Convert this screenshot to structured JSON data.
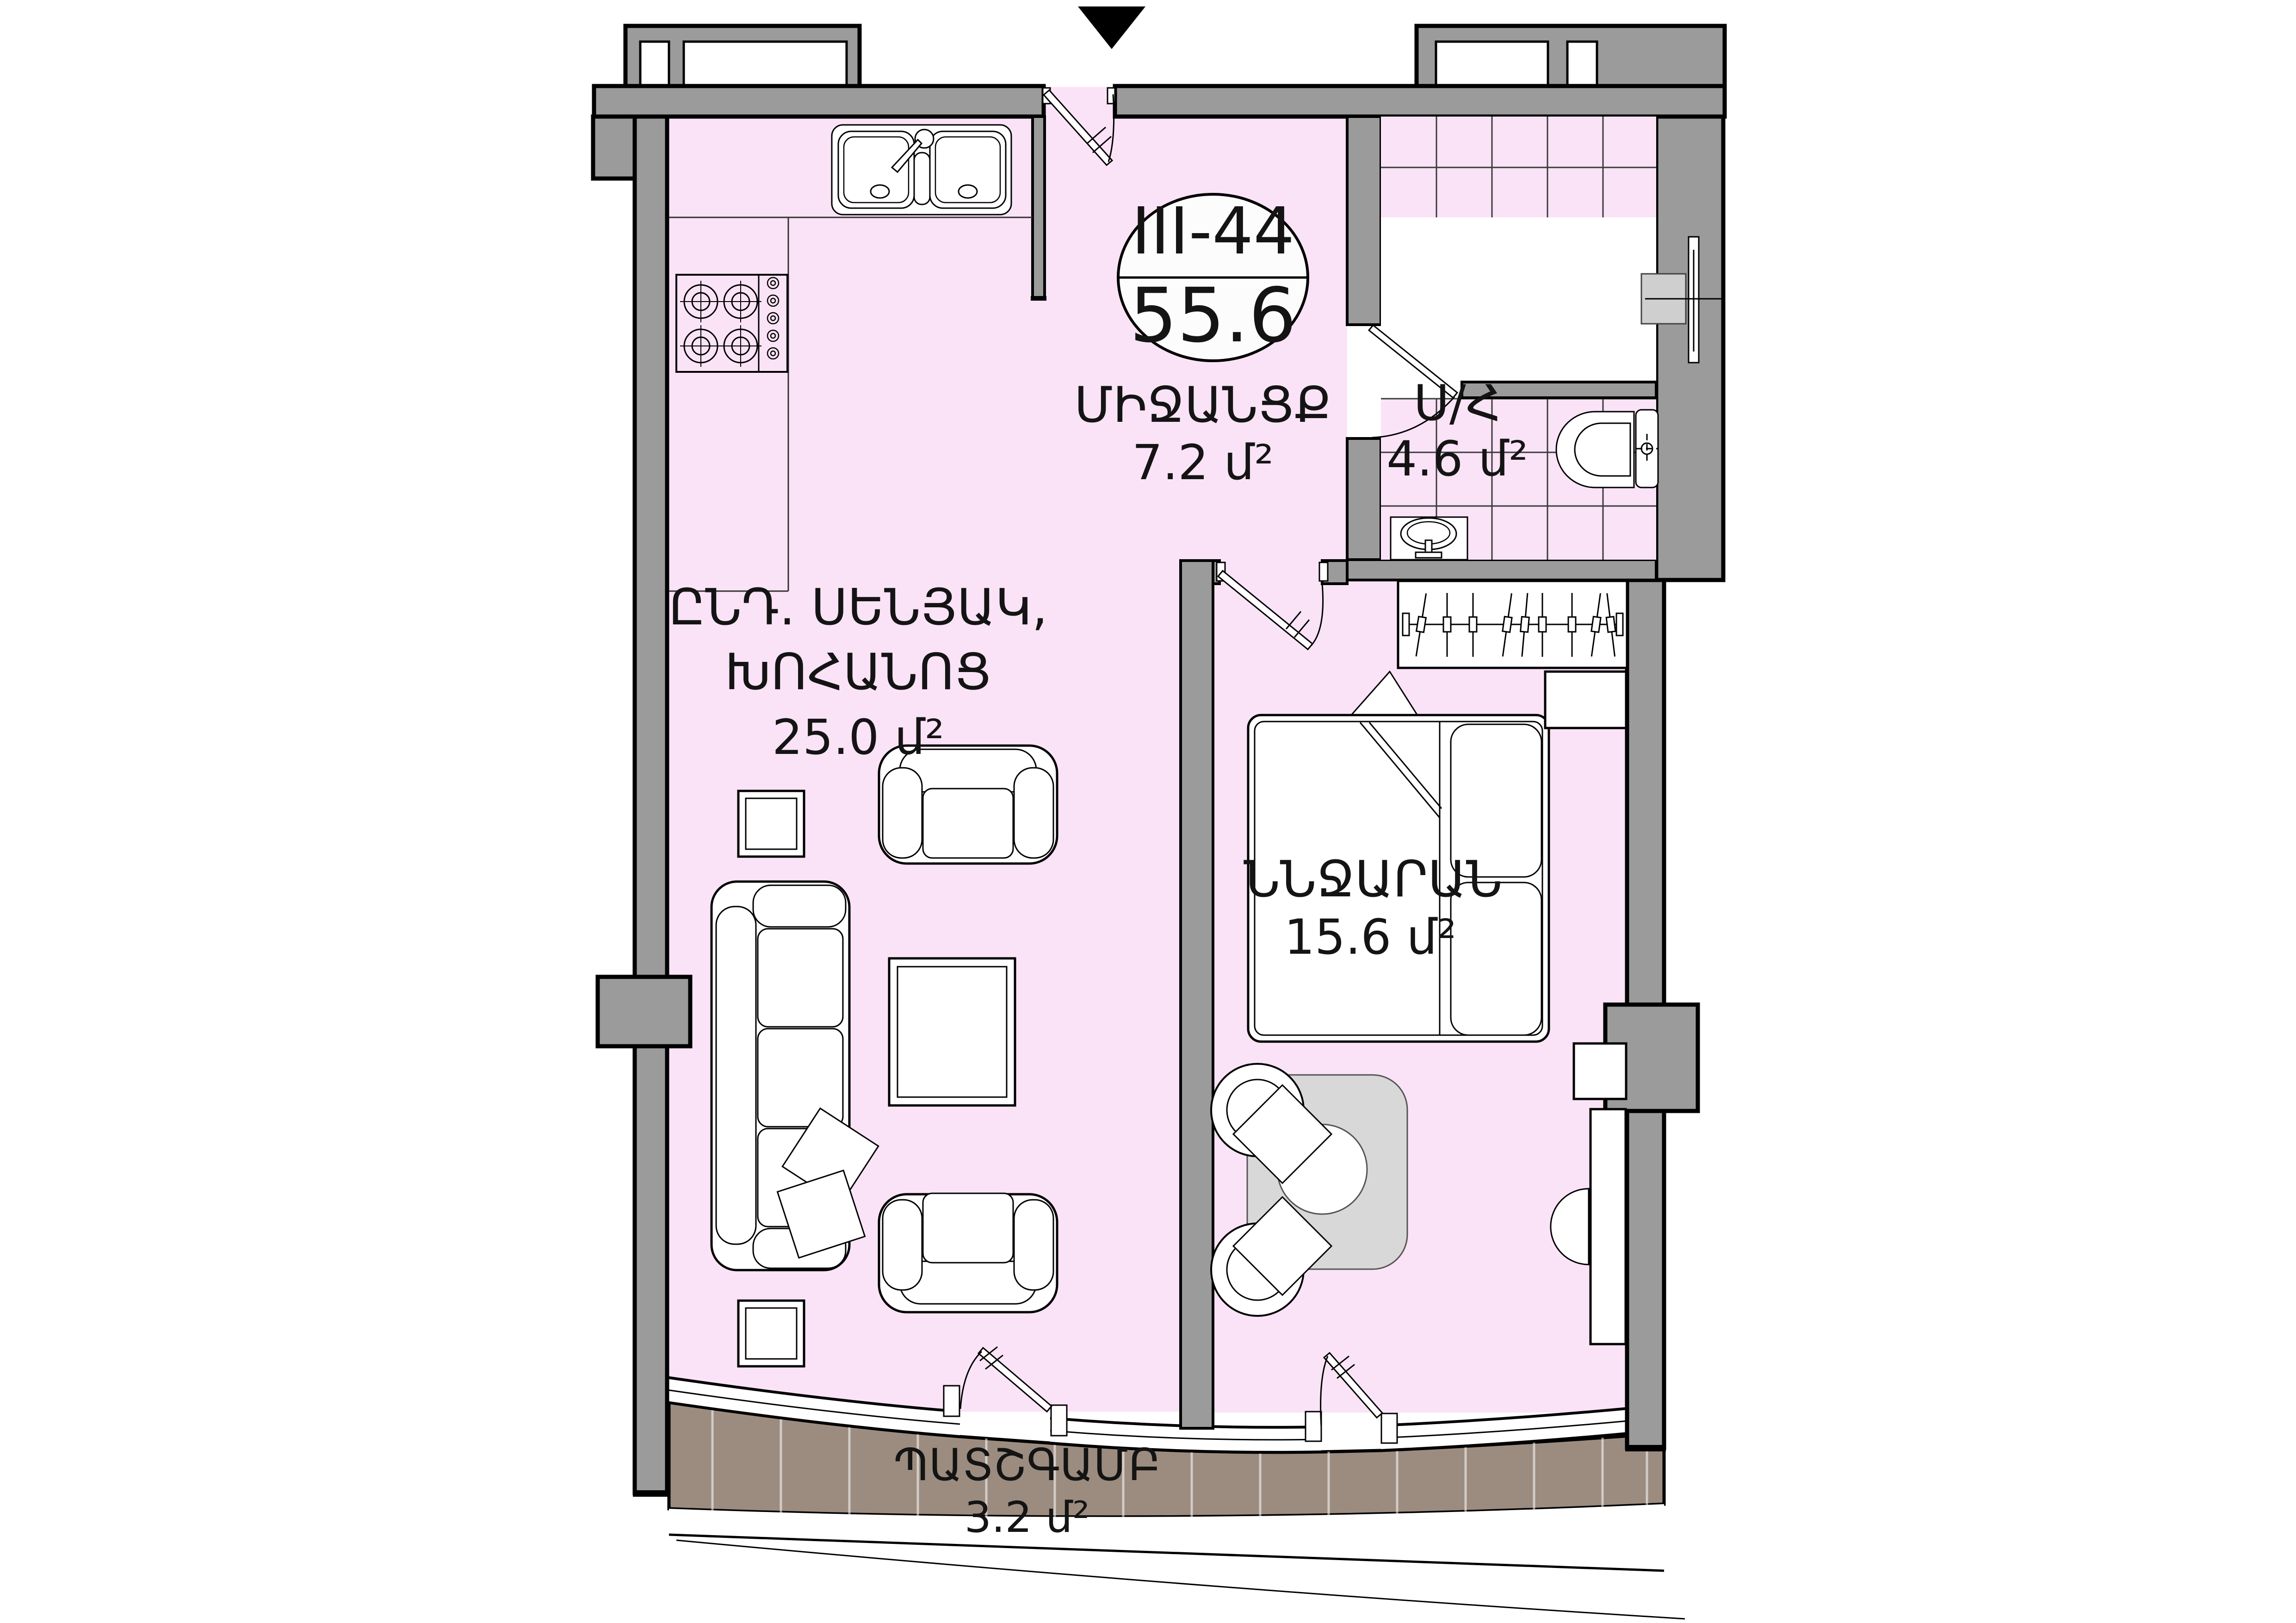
{
  "plan": {
    "unit": {
      "id": "III-44",
      "total_area": "55.6"
    },
    "rooms": {
      "hallway": {
        "name": "ՄԻՋԱՆՑՔ",
        "area": "7.2 մ²"
      },
      "bathroom": {
        "name": "Ս/Հ",
        "area": "4.6 մ²"
      },
      "living": {
        "name_line1": "ԸՆԴ. ՍԵՆՅԱԿ,",
        "name_line2": "ԽՈՀԱՆՈՑ",
        "area": "25.0 մ²"
      },
      "bedroom": {
        "name": "ՆՆՋԱՐԱՆ",
        "area": "15.6 մ²"
      },
      "balcony": {
        "name": "ՊԱՏՇԳԱՄԲ",
        "area": "3.2 մ²"
      }
    },
    "colors": {
      "paper": "#ffffff",
      "ink": "#000000",
      "wall_gray": "#9b9b9b",
      "interior_pink": "#fae3f6",
      "balcony_brown": "#9c8c80",
      "furniture_gray": "#d8d8d8",
      "tile_line": "#3b3b3b",
      "badge_fill": "#fcfcfc"
    },
    "icons": [
      "entrance-marker-icon",
      "unit-badge",
      "kitchen-sink-icon",
      "stove-icon",
      "sofa-icon",
      "armchair-icon",
      "coffee-table-icon",
      "side-table-icon",
      "bed-icon",
      "pillow-icon",
      "nightstand-icon",
      "wardrobe-icon",
      "dining-table-icon",
      "chair-icon",
      "stool-icon",
      "dresser-icon",
      "toilet-icon",
      "washbasin-icon",
      "shower-mixer-icon",
      "door-icon",
      "window-icon"
    ]
  }
}
